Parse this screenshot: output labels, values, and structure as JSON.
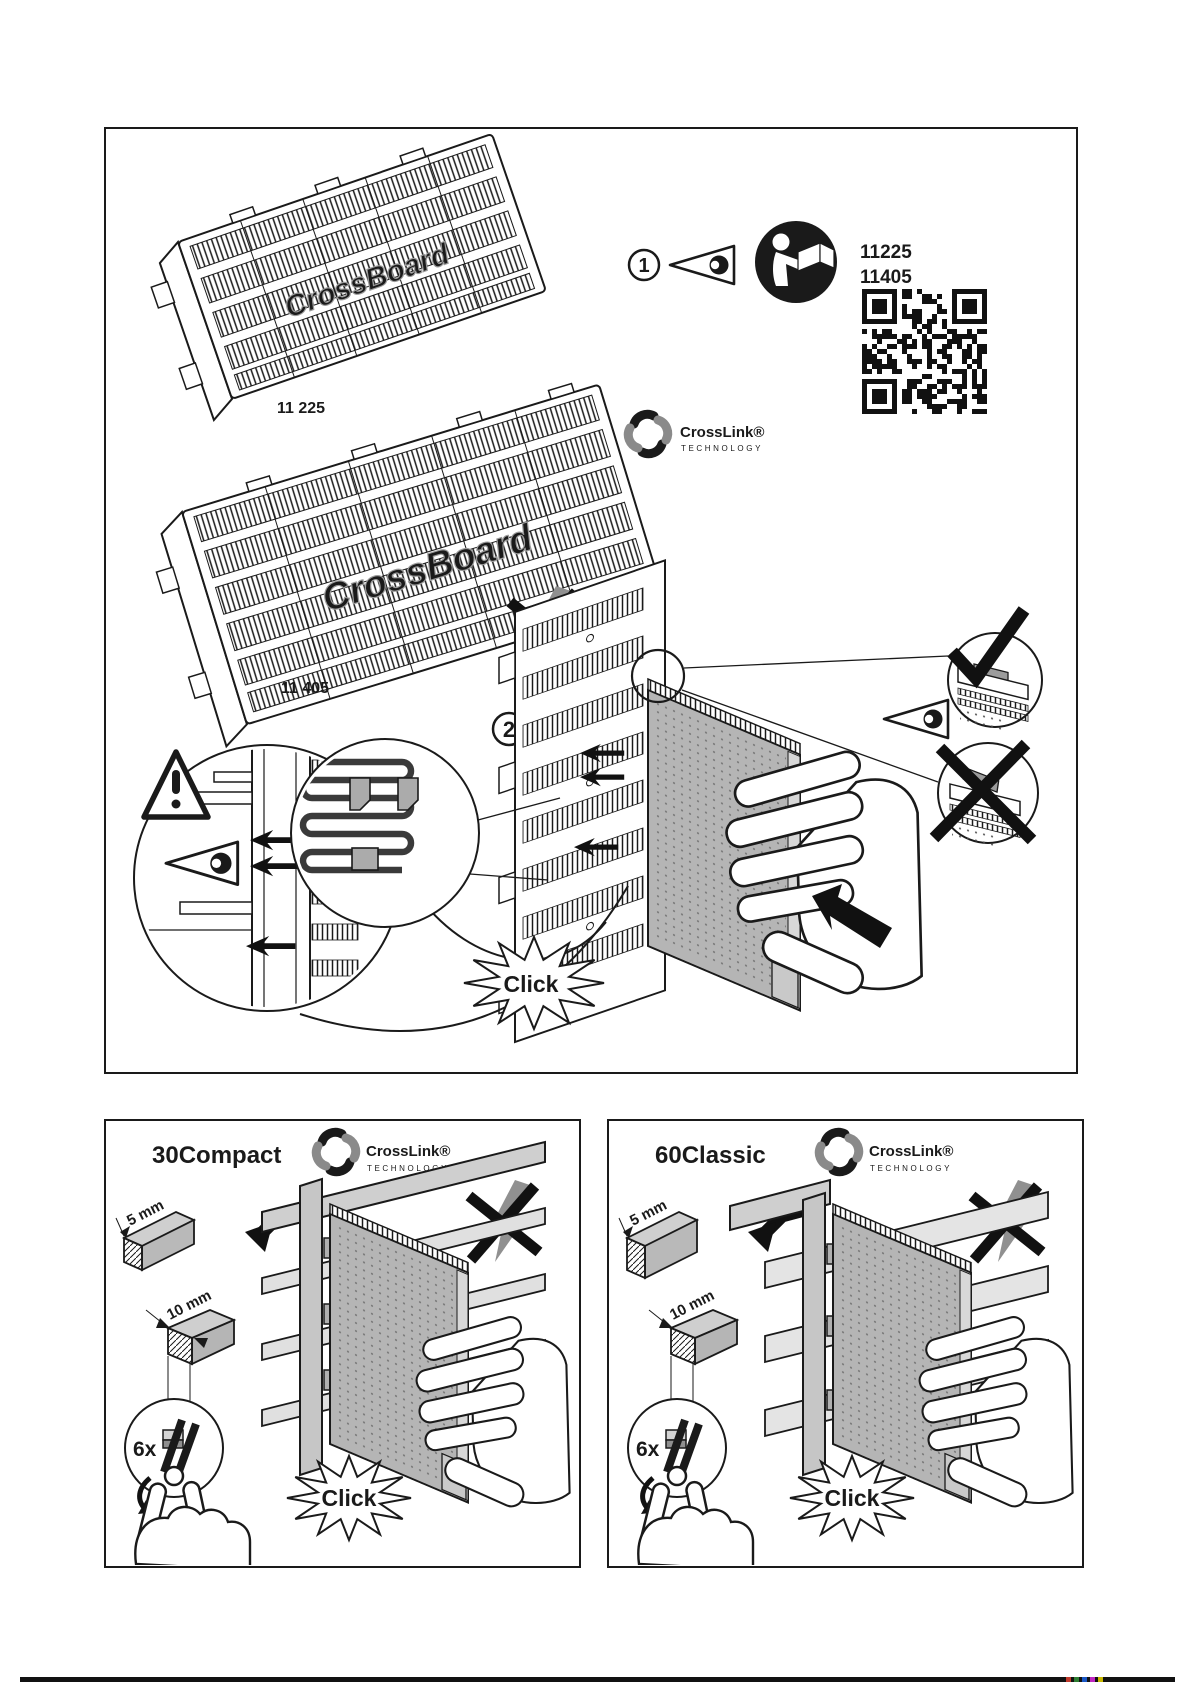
{
  "branding": {
    "logo_text": "CrossLink®",
    "logo_sub": "TECHNOLOGY",
    "board_emboss": "CrossBoard"
  },
  "top_panel": {
    "step1": {
      "number": "1",
      "code_line1": "11225",
      "code_line2": "11405"
    },
    "step2": {
      "number": "2",
      "click_label": "Click"
    },
    "blocks": [
      {
        "label": "11 225"
      },
      {
        "label": "11 405"
      }
    ]
  },
  "panels": [
    {
      "title": "30Compact",
      "dim_small": "5 mm",
      "dim_large": "10 mm",
      "repeat_count": "6x",
      "click_label": "Click"
    },
    {
      "title": "60Classic",
      "dim_small": "5 mm",
      "dim_large": "10 mm",
      "repeat_count": "6x",
      "click_label": "Click"
    }
  ],
  "icons": [
    "eye-icon",
    "read-manual-icon",
    "qr-code",
    "warning-triangle-icon",
    "check-mark-icon",
    "cross-mark-icon",
    "no-slide-down-icon",
    "hook-in-arrow-icon",
    "push-arrow-icon",
    "pliers-icon",
    "hand-icon",
    "click-burst",
    "magnifier-circle",
    "step-circle",
    "crosslink-logo"
  ],
  "colors": {
    "ink": "#1a1a1a",
    "paper": "#ffffff",
    "module_gray": "#b5b5b5",
    "rail_gray": "#e0e0e0",
    "profile_gray": "#c6c6c6",
    "warn_arrow_gray": "#909090",
    "logo_gray": "#8a8a8a"
  }
}
